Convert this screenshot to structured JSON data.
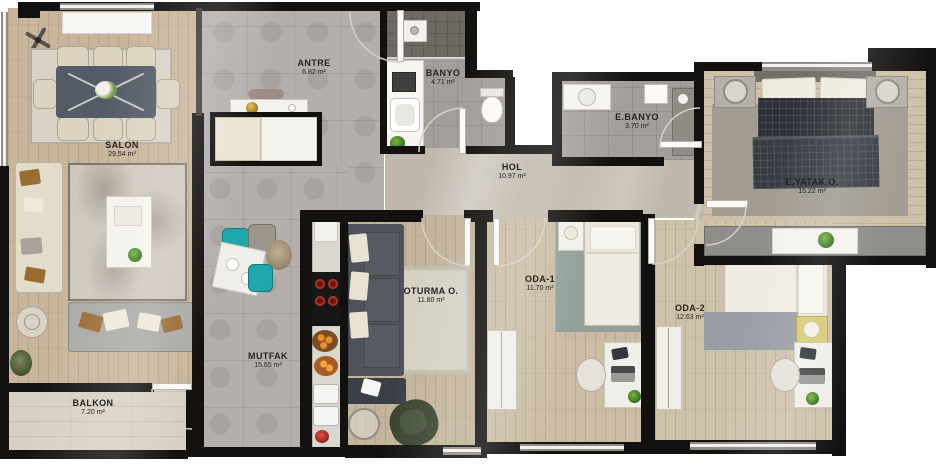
{
  "floor_plan": {
    "rooms": [
      {
        "id": "salon",
        "name": "SALON",
        "area": "29.54 m²"
      },
      {
        "id": "antre",
        "name": "ANTRE",
        "area": "6.82 m²"
      },
      {
        "id": "banyo",
        "name": "BANYO",
        "area": "4.71 m²"
      },
      {
        "id": "ebanyo",
        "name": "E.BANYO",
        "area": "3.70 m²"
      },
      {
        "id": "hol",
        "name": "HOL",
        "area": "10.97 m²"
      },
      {
        "id": "eyatak",
        "name": "E.YATAK O.",
        "area": "15.22 m²"
      },
      {
        "id": "oturma",
        "name": "OTURMA O.",
        "area": "11.80 m²"
      },
      {
        "id": "oda1",
        "name": "ODA-1",
        "area": "11.70 m²"
      },
      {
        "id": "oda2",
        "name": "ODA-2",
        "area": "12.63 m²"
      },
      {
        "id": "mutfak",
        "name": "MUTFAK",
        "area": "15.65 m²"
      },
      {
        "id": "balkon",
        "name": "BALKON",
        "area": "7.20 m²"
      }
    ],
    "colors": {
      "wall": "#121110",
      "salon_wood": "#c8b59b",
      "bedroom_wood": "#cec0a9",
      "tile_gray": "#b4afac",
      "hol_tile": "#c0b8ac",
      "balcony_wood": "#d8d0c3",
      "accent_teal": "#1fa7ac",
      "burner_red": "#c43b2d",
      "sofa_dark": "#4e535b",
      "bed_plaid": "#2e3238",
      "nightstand_yellow": "#d6cb74"
    }
  }
}
